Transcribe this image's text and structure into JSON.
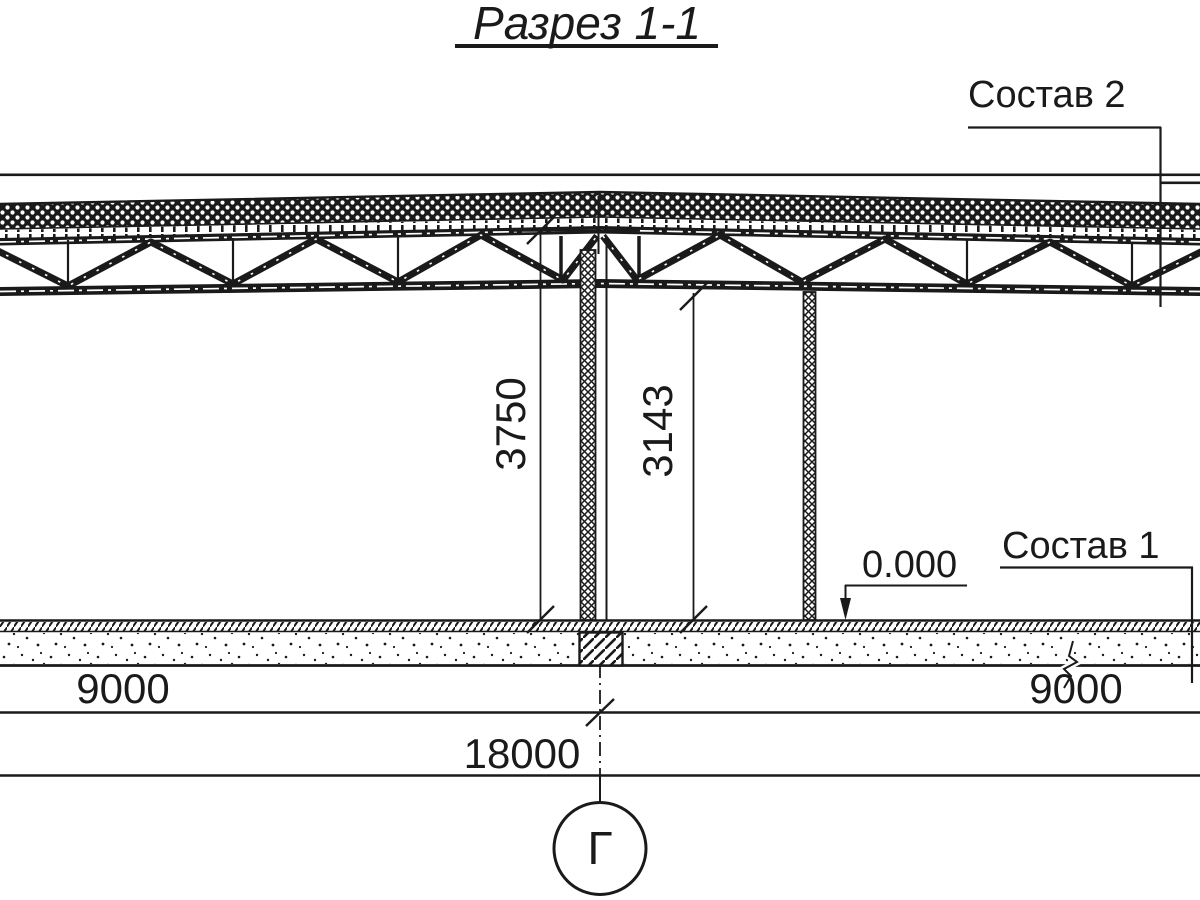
{
  "title": {
    "text": "Разрез 1-1"
  },
  "callouts": {
    "composition2": "Состав 2",
    "composition1": "Состав 1",
    "elevation": "0.000"
  },
  "dimensions": {
    "height_ridge": "3750",
    "height_clear": "3143",
    "bay_left": "9000",
    "bay_right": "9000",
    "total": "18000"
  },
  "grid": {
    "axis_label": "Г"
  },
  "colors": {
    "ink": "#1a1a1a",
    "paper": "#ffffff"
  }
}
